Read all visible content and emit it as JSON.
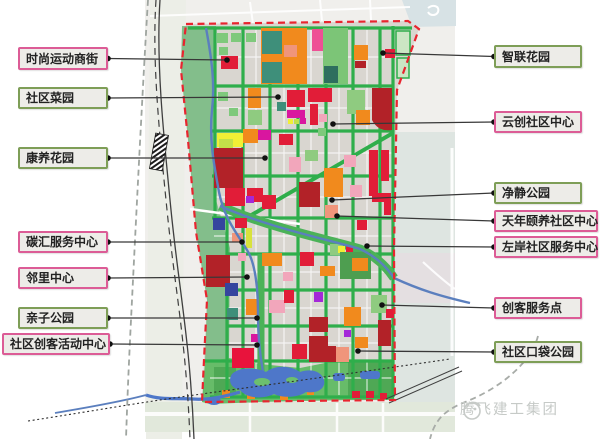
{
  "watermark": {
    "text": "腾飞建工集团"
  },
  "colors": {
    "pink_border": "#DC5C96",
    "green_border": "#7E9E57",
    "box_fill": "#EDECE8",
    "box_text": "#222222",
    "callout_line": "#383838",
    "boundary": "#E8252F",
    "road_green": "#2FAE4B",
    "water": "#5B7FBE",
    "park_green": "#67BC69",
    "orange": "#F18A1D",
    "crimson": "#B22228",
    "red": "#E11D38"
  },
  "callouts": [
    {
      "id": "fashion-sports-street",
      "label": "时尚运动商街",
      "side": "left",
      "style": "pink",
      "box": {
        "x": 18,
        "y": 47,
        "w": 90,
        "h": 23
      },
      "target": {
        "x": 227,
        "y": 60
      }
    },
    {
      "id": "community-garden",
      "label": "社区菜园",
      "side": "left",
      "style": "green",
      "box": {
        "x": 18,
        "y": 87,
        "w": 90,
        "h": 22
      },
      "target": {
        "x": 278,
        "y": 97
      }
    },
    {
      "id": "wellness-garden",
      "label": "康养花园",
      "side": "left",
      "style": "green",
      "box": {
        "x": 18,
        "y": 147,
        "w": 90,
        "h": 22
      },
      "target": {
        "x": 265,
        "y": 158
      }
    },
    {
      "id": "carbon-service-center",
      "label": "碳汇服务中心",
      "side": "left",
      "style": "pink",
      "box": {
        "x": 18,
        "y": 231,
        "w": 90,
        "h": 22
      },
      "target": {
        "x": 242,
        "y": 242
      }
    },
    {
      "id": "neighborhood-center",
      "label": "邻里中心",
      "side": "left",
      "style": "pink",
      "box": {
        "x": 18,
        "y": 267,
        "w": 90,
        "h": 22
      },
      "target": {
        "x": 247,
        "y": 277
      }
    },
    {
      "id": "parent-child-park",
      "label": "亲子公园",
      "side": "left",
      "style": "green",
      "box": {
        "x": 18,
        "y": 307,
        "w": 90,
        "h": 22
      },
      "target": {
        "x": 257,
        "y": 318
      }
    },
    {
      "id": "community-maker-activity-center",
      "label": "社区创客活动中心",
      "side": "left",
      "style": "pink",
      "box": {
        "x": 2,
        "y": 333,
        "w": 108,
        "h": 22
      },
      "target": {
        "x": 257,
        "y": 345
      }
    },
    {
      "id": "smart-link-garden",
      "label": "智联花园",
      "side": "right",
      "style": "green",
      "box": {
        "x": 494,
        "y": 45,
        "w": 88,
        "h": 23
      },
      "target": {
        "x": 383,
        "y": 53
      }
    },
    {
      "id": "cloud-maker-community-center",
      "label": "云创社区中心",
      "side": "right",
      "style": "pink",
      "box": {
        "x": 494,
        "y": 111,
        "w": 88,
        "h": 22
      },
      "target": {
        "x": 333,
        "y": 124
      }
    },
    {
      "id": "quiet-park",
      "label": "净静公园",
      "side": "right",
      "style": "green",
      "box": {
        "x": 494,
        "y": 182,
        "w": 88,
        "h": 22
      },
      "target": {
        "x": 332,
        "y": 200
      }
    },
    {
      "id": "senior-wellness-community-center",
      "label": "天年颐养社区中心",
      "side": "right",
      "style": "pink",
      "box": {
        "x": 494,
        "y": 210,
        "w": 104,
        "h": 22
      },
      "target": {
        "x": 337,
        "y": 216
      }
    },
    {
      "id": "left-bank-community-service-center",
      "label": "左岸社区服务中心",
      "side": "right",
      "style": "pink",
      "box": {
        "x": 494,
        "y": 236,
        "w": 104,
        "h": 22
      },
      "target": {
        "x": 367,
        "y": 246
      }
    },
    {
      "id": "maker-service-point",
      "label": "创客服务点",
      "side": "right",
      "style": "pink",
      "box": {
        "x": 494,
        "y": 297,
        "w": 88,
        "h": 22
      },
      "target": {
        "x": 382,
        "y": 305
      }
    },
    {
      "id": "community-pocket-park",
      "label": "社区口袋公园",
      "side": "right",
      "style": "green",
      "box": {
        "x": 494,
        "y": 341,
        "w": 88,
        "h": 22
      },
      "target": {
        "x": 358,
        "y": 351
      }
    }
  ]
}
